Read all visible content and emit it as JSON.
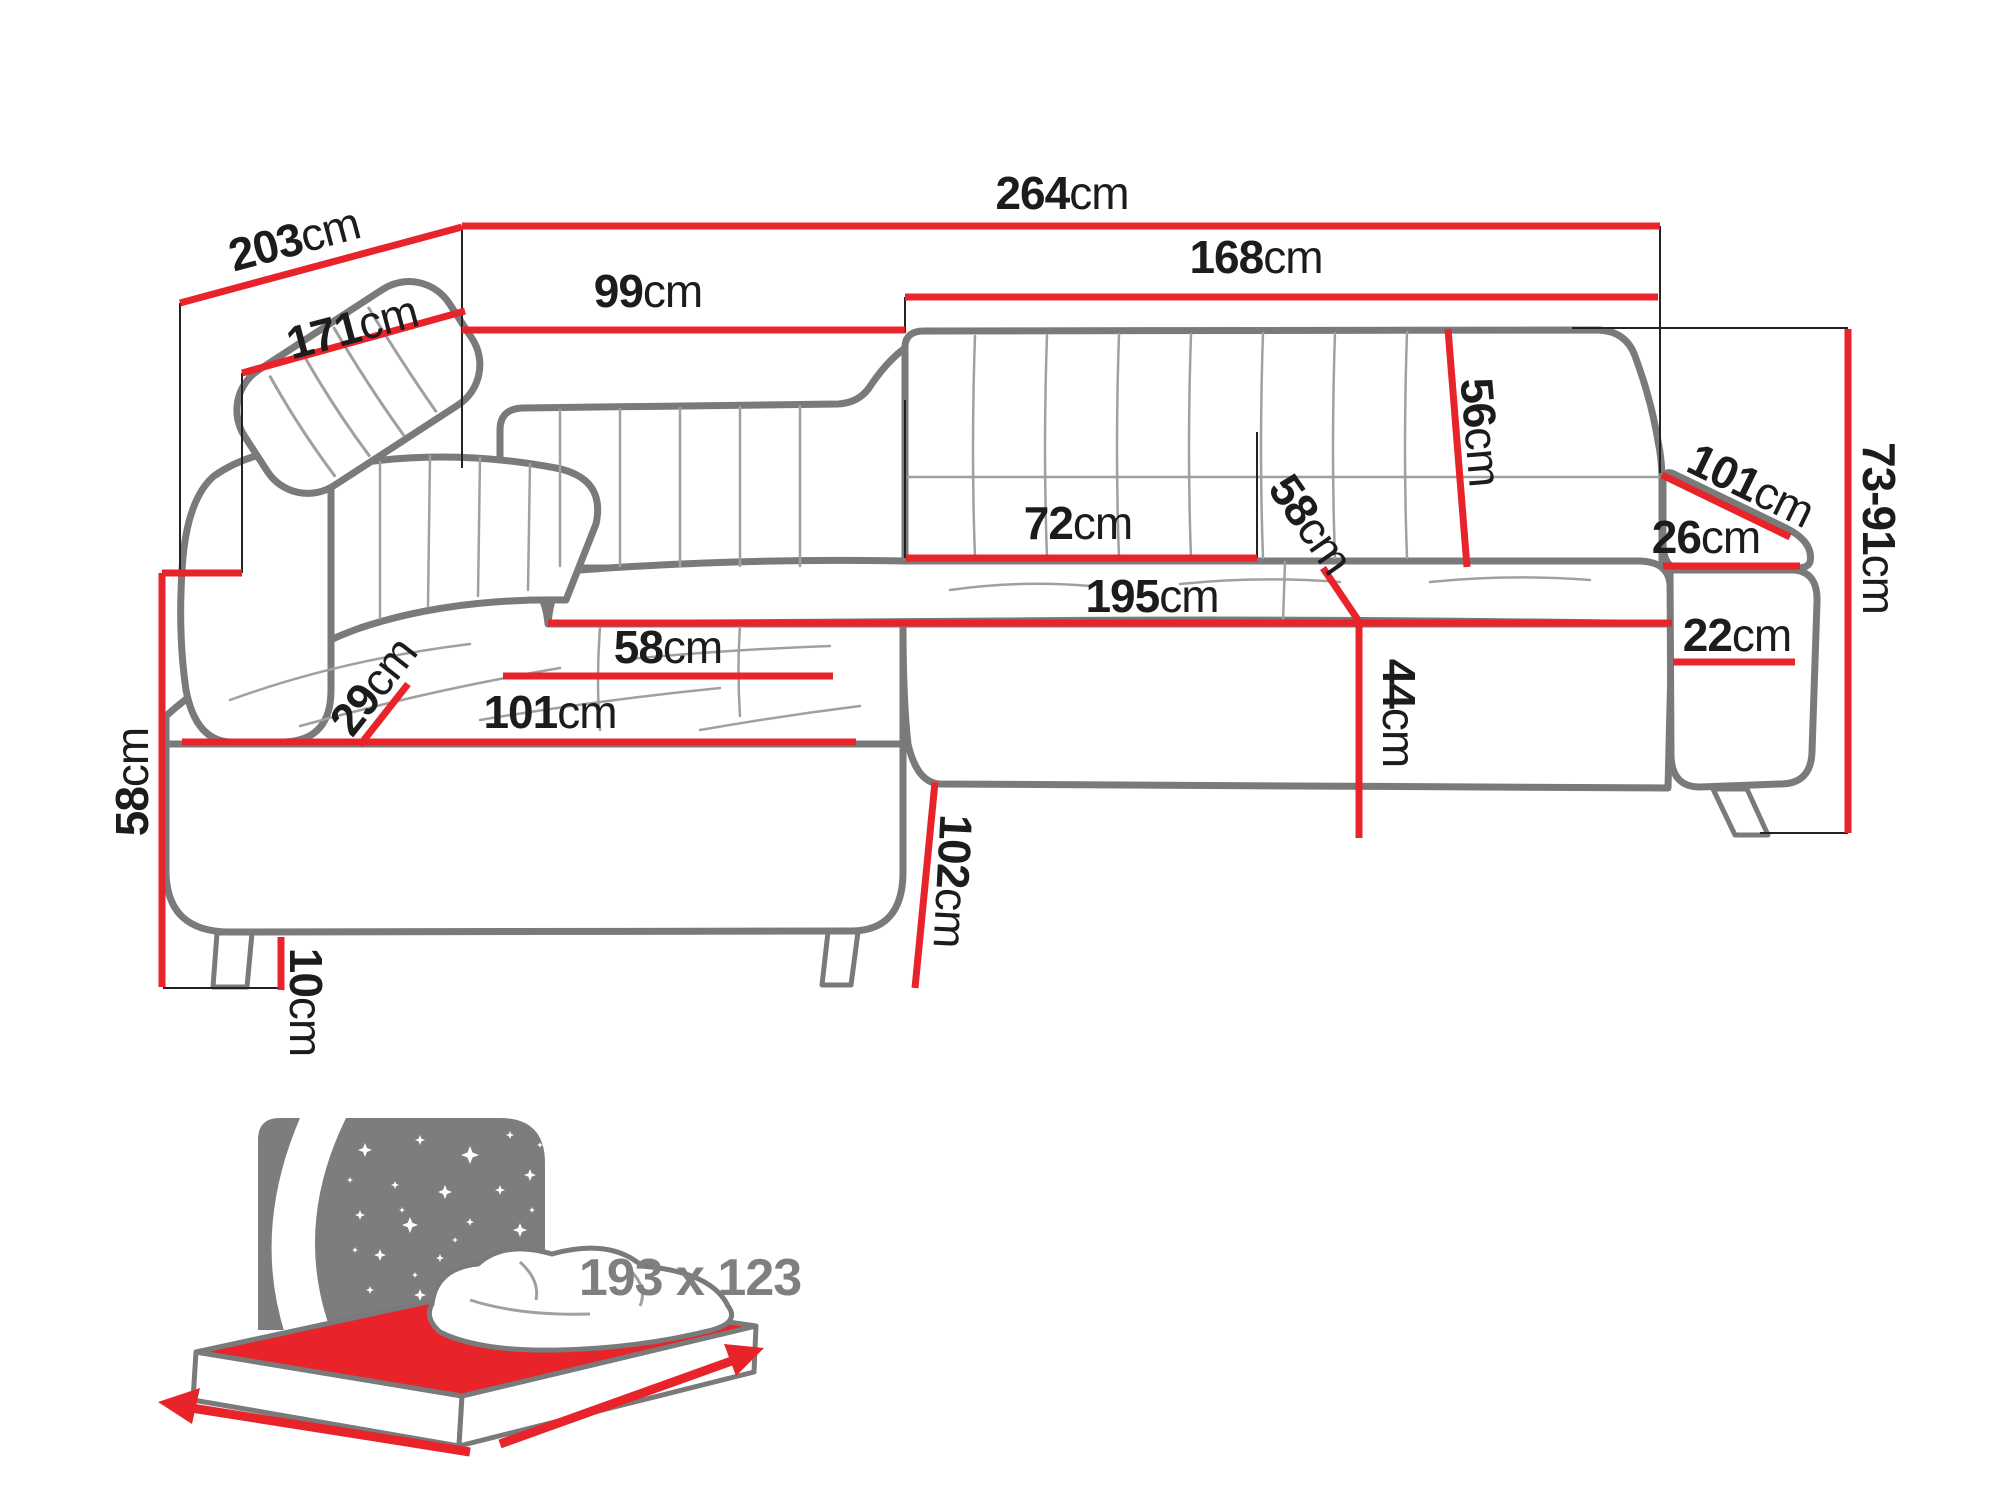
{
  "diagram_type": "corner-sofa dimension drawing",
  "unit": "cm",
  "colors": {
    "dimension_red": "#e8232a",
    "sofa_outline_gray": "#7a7a7a",
    "detail_gray": "#a0a0a0",
    "label_black": "#1c1c1c",
    "icon_gray": "#7d7d7d",
    "mattress_red": "#e8232a"
  },
  "labels": [
    {
      "id": "width-total",
      "num": "264",
      "unit": "cm",
      "x": 1062,
      "y": 193,
      "rot": 0,
      "style": "black"
    },
    {
      "id": "depth-total",
      "num": "203",
      "unit": "cm",
      "x": 294,
      "y": 239,
      "rot": -15,
      "style": "black"
    },
    {
      "id": "depth-inner",
      "num": "171",
      "unit": "cm",
      "x": 352,
      "y": 327,
      "rot": -15,
      "style": "black"
    },
    {
      "id": "width-left-section",
      "num": "99",
      "unit": "cm",
      "x": 648,
      "y": 291,
      "rot": 0,
      "style": "black"
    },
    {
      "id": "width-right-section",
      "num": "168",
      "unit": "cm",
      "x": 1256,
      "y": 257,
      "rot": 0,
      "style": "black"
    },
    {
      "id": "backrest-height",
      "num": "56",
      "unit": "cm",
      "x": 1481,
      "y": 432,
      "rot": 85,
      "style": "black"
    },
    {
      "id": "seat-width-mid",
      "num": "72",
      "unit": "cm",
      "x": 1078,
      "y": 523,
      "rot": 0,
      "style": "black"
    },
    {
      "id": "seat-depth-right",
      "num": "58",
      "unit": "cm",
      "x": 1311,
      "y": 524,
      "rot": 55,
      "style": "black"
    },
    {
      "id": "seat-length",
      "num": "195",
      "unit": "cm",
      "x": 1152,
      "y": 596,
      "rot": 0,
      "style": "black"
    },
    {
      "id": "chaise-seat-width",
      "num": "58",
      "unit": "cm",
      "x": 668,
      "y": 647,
      "rot": 0,
      "style": "black"
    },
    {
      "id": "chaise-length",
      "num": "101",
      "unit": "cm",
      "x": 550,
      "y": 712,
      "rot": 0,
      "style": "black"
    },
    {
      "id": "armrest-left-width",
      "num": "29",
      "unit": "cm",
      "x": 373,
      "y": 686,
      "rot": -52,
      "style": "black"
    },
    {
      "id": "height-left",
      "num": "58",
      "unit": "cm",
      "x": 132,
      "y": 782,
      "rot": -90,
      "style": "black"
    },
    {
      "id": "leg-height",
      "num": "10",
      "unit": "cm",
      "x": 306,
      "y": 1002,
      "rot": 90,
      "style": "black"
    },
    {
      "id": "chaise-depth",
      "num": "102",
      "unit": "cm",
      "x": 953,
      "y": 881,
      "rot": 93,
      "style": "black"
    },
    {
      "id": "seat-height",
      "num": "44",
      "unit": "cm",
      "x": 1399,
      "y": 713,
      "rot": 90,
      "style": "black"
    },
    {
      "id": "armrest-right-length",
      "num": "101",
      "unit": "cm",
      "x": 1751,
      "y": 485,
      "rot": 26,
      "style": "black"
    },
    {
      "id": "armrest-right-width",
      "num": "26",
      "unit": "cm",
      "x": 1706,
      "y": 537,
      "rot": 0,
      "style": "black"
    },
    {
      "id": "armrest-right-height",
      "num": "22",
      "unit": "cm",
      "x": 1737,
      "y": 635,
      "rot": 0,
      "style": "black"
    },
    {
      "id": "height-range-right",
      "num": "73-91",
      "unit": "cm",
      "x": 1879,
      "y": 528,
      "rot": 90,
      "style": "black"
    },
    {
      "id": "sleeping-area-size",
      "num": "193 x 123",
      "unit": "",
      "x": 690,
      "y": 1278,
      "rot": 0,
      "style": "gray"
    }
  ],
  "bed_icon": {
    "meaning": "fold-out sleeping function",
    "size_label": "193 x 123"
  }
}
